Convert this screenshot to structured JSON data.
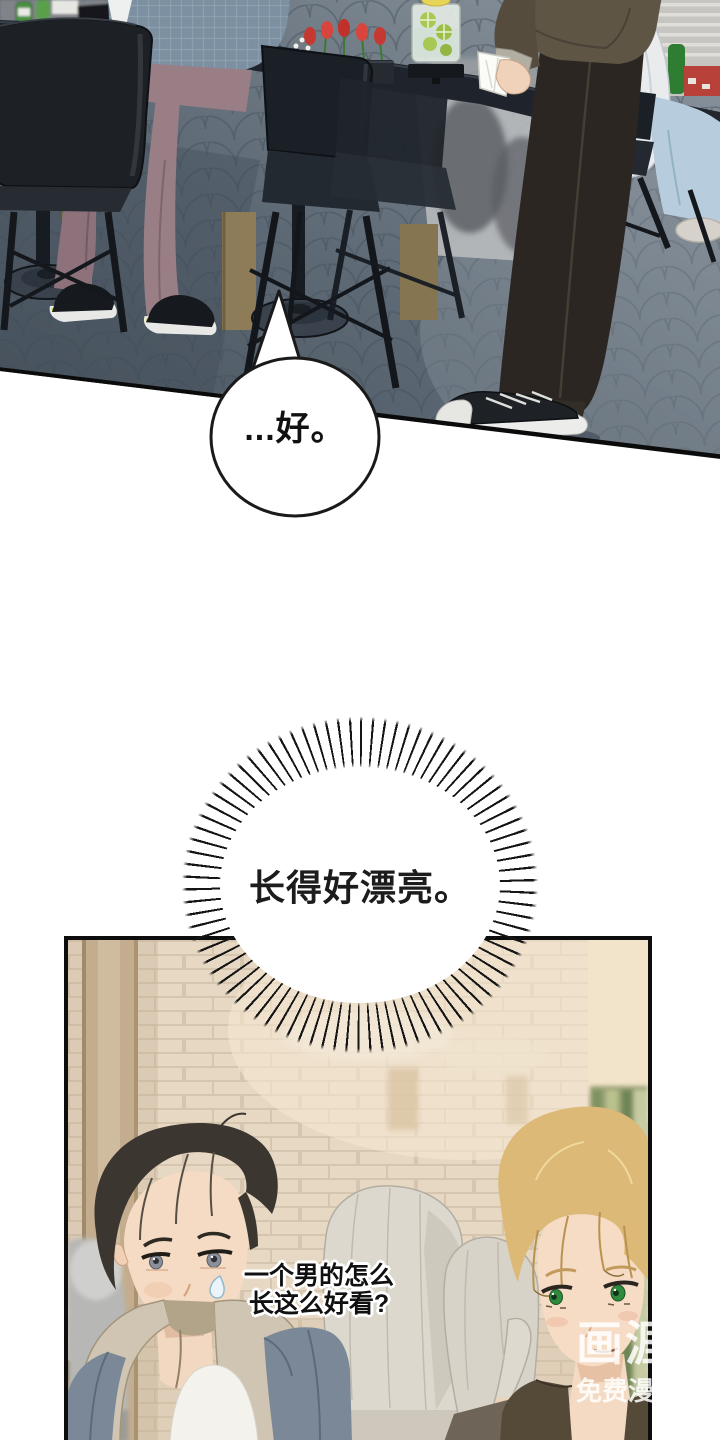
{
  "page": {
    "width": 720,
    "height": 1440,
    "background": "#ffffff"
  },
  "dialogue": {
    "bubble": {
      "text": "...好。"
    },
    "burst": {
      "text": "长得好漂亮。"
    },
    "thought": {
      "line1": "一个男的怎么",
      "line2": "长这么好看?"
    }
  },
  "watermark": {
    "brand": "画涯",
    "tagline": "免费漫画"
  },
  "colors": {
    "ink": "#111111",
    "panel_border": "#0d0d0d",
    "bubble_fill": "#ffffff",
    "watermark_text": "#ffffff",
    "carpet": "#5d6974",
    "wall_brick": "#e6d8c4"
  }
}
